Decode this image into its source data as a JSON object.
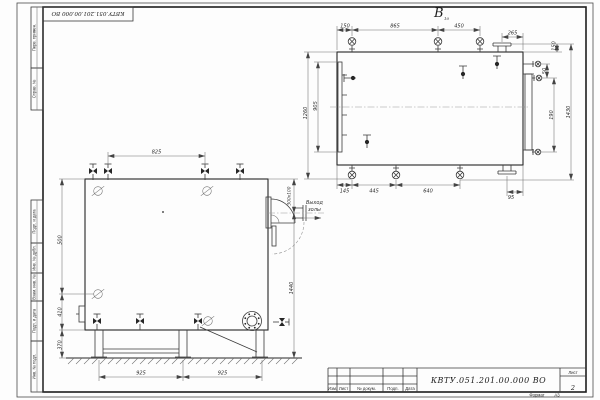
{
  "sheet": {
    "stamp_code": "КВТУ.051.201.00.000 ВО",
    "left_margin_labels": [
      "Перв. примен.",
      "Справ. №",
      "Подп. и дата",
      "Инв. № дубл.",
      "Взам. инв. №",
      "Подп. и дата",
      "Инв. № подл."
    ],
    "title_block": {
      "doc_number": "КВТУ.051.201.00.000  ВО",
      "row_labels": [
        "Изм.",
        "Лист",
        "№ докум.",
        "Подп.",
        "Дата"
      ],
      "sheet_label": "Лист",
      "sheet_number": "2",
      "format_label": "Формат",
      "format_value": "А3"
    }
  },
  "views": {
    "view_b": {
      "label": "В",
      "label_sub": "10",
      "dims": {
        "top": [
          "150",
          "865",
          "450"
        ],
        "flange_offset": "265",
        "flange_height": "150",
        "right": [
          "50",
          "190",
          "1430"
        ],
        "left_outer": "1260",
        "left_inner": "905",
        "bottom": [
          "145",
          "445",
          "640"
        ],
        "bottom_right": "95"
      }
    },
    "front": {
      "dims": {
        "top": "825",
        "left": [
          "500",
          "410",
          "370"
        ],
        "bottom": [
          "925",
          "925"
        ],
        "outlet_section": "300х100",
        "outlet_height": "1440"
      },
      "outlet_label": [
        "Выход",
        "золы"
      ]
    }
  }
}
